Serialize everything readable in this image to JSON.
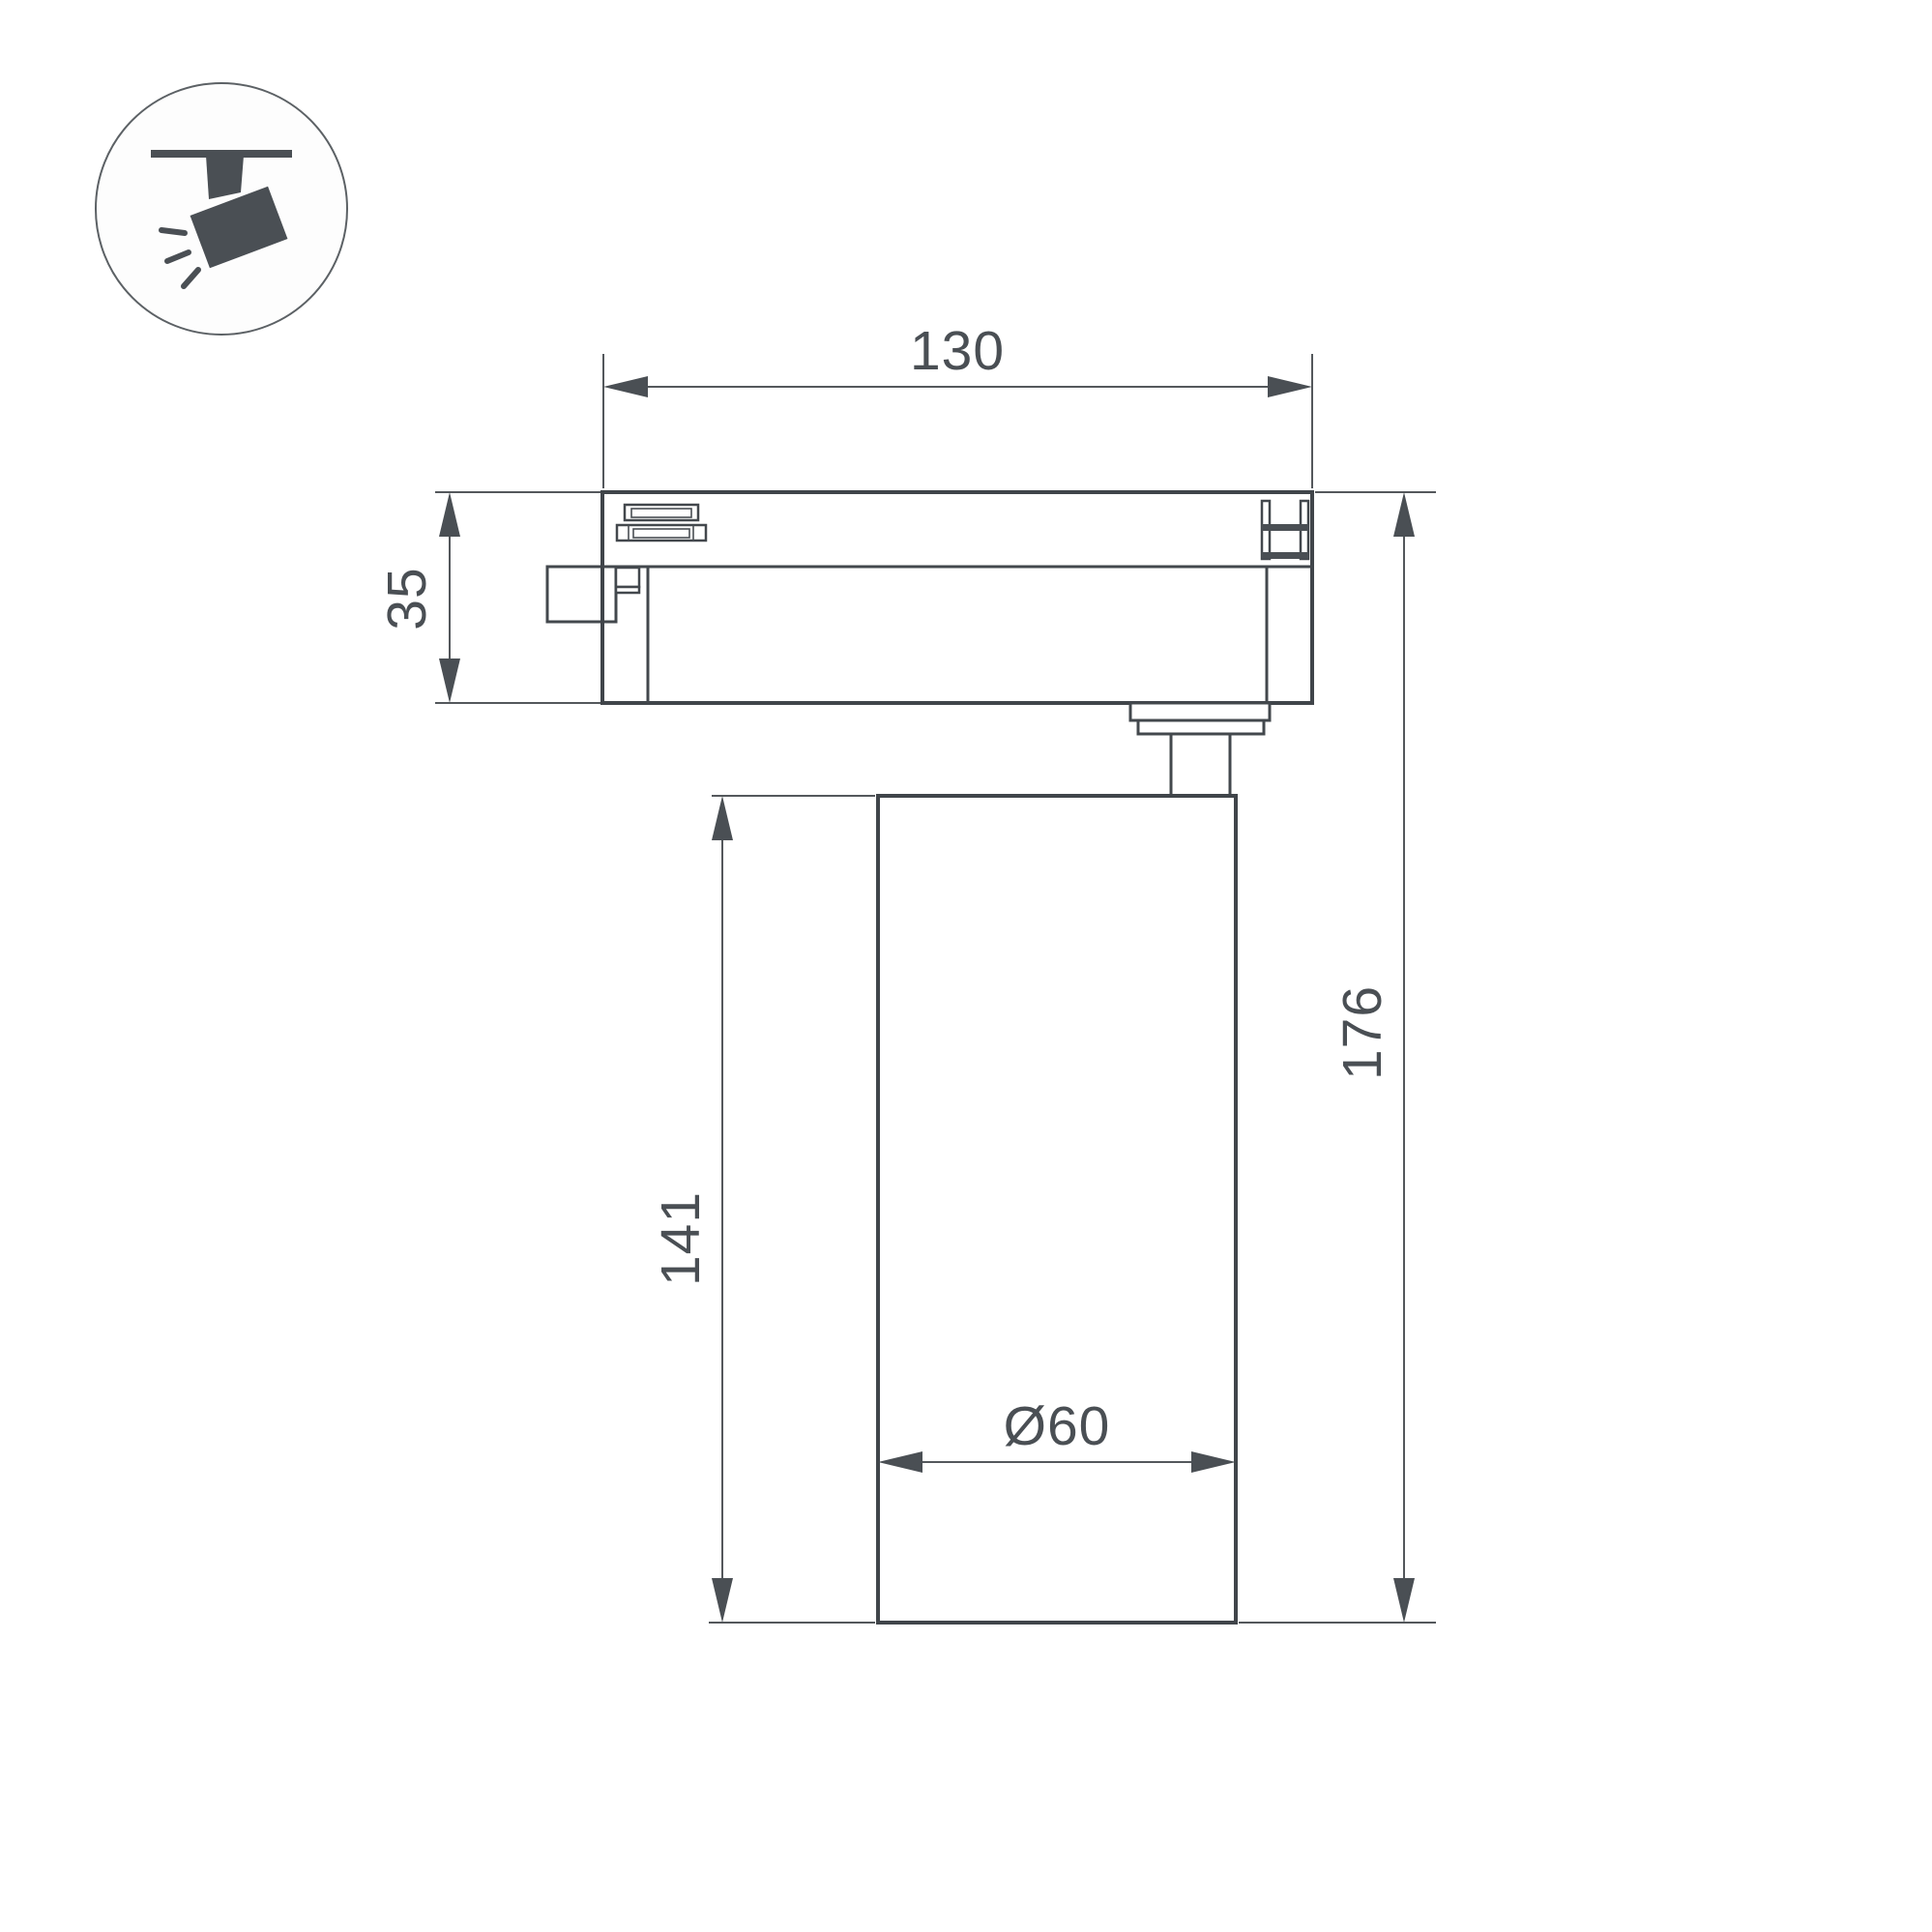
{
  "drawing": {
    "type": "technical-dimension-drawing",
    "subject": "track-mounted spotlight, side view",
    "background_color": "#ffffff",
    "line_color": "#43484d",
    "dimension_line_color": "#54585c",
    "text_color": "#4a4f54",
    "icon": {
      "name": "track-spotlight-icon",
      "description": "circled pictogram of a spotlight hanging from a ceiling track with light rays"
    },
    "dimensions": {
      "adapter_width": {
        "value": "130",
        "orientation": "horizontal",
        "location": "top, width of track adapter"
      },
      "adapter_height": {
        "value": "35",
        "orientation": "vertical",
        "location": "left, height of track adapter"
      },
      "body_height": {
        "value": "141",
        "orientation": "vertical",
        "location": "left, height of cylindrical lamp body"
      },
      "total_height": {
        "value": "176",
        "orientation": "vertical",
        "location": "right, overall height"
      },
      "body_diameter": {
        "value": "Ø60",
        "orientation": "horizontal",
        "location": "inside lamp body, diameter"
      }
    }
  }
}
